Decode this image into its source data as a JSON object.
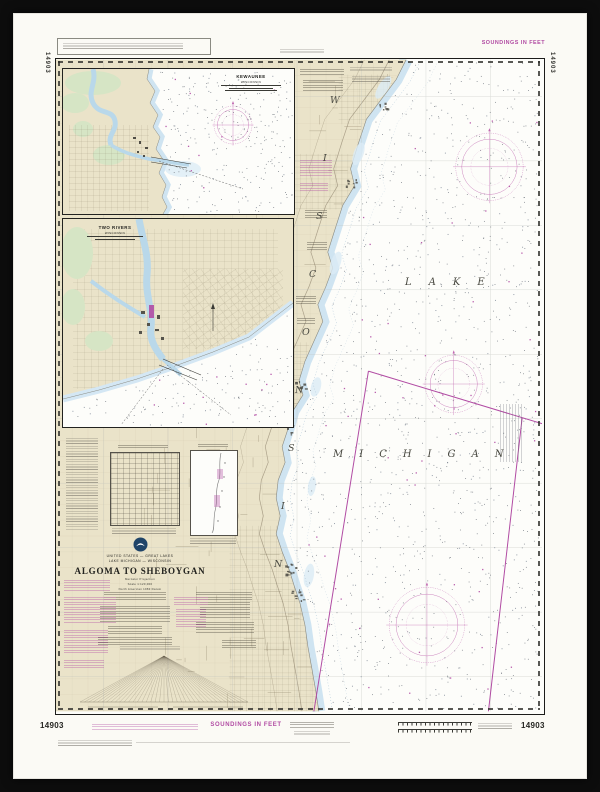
{
  "colors": {
    "frame": "#0d0d0d",
    "paper": "#fbfaf5",
    "land_tan": "#eae3c9",
    "shallow_blue": "#cfe4f1",
    "park_green": "#d6e5c5",
    "magenta_accent": "#b14ba3",
    "ink": "#22221f"
  },
  "margins": {
    "soundings_top": "SOUNDINGS IN FEET",
    "soundings_bottom": "SOUNDINGS IN FEET",
    "chart_number": "14903"
  },
  "title_block": {
    "nation_line": "UNITED STATES — GREAT LAKES",
    "region_line": "LAKE MICHIGAN — WISCONSIN",
    "title": "ALGOMA TO SHEBOYGAN",
    "projection_line": "Mercator Projection",
    "scale_line": "Scale 1:120,000",
    "datum_line": "North American 1983 Datum"
  },
  "insets": [
    {
      "title": "KEWAUNEE",
      "subtitle": "WISCONSIN"
    },
    {
      "title": "TWO RIVERS",
      "subtitle": "WISCONSIN"
    }
  ],
  "map_labels": {
    "lake": "LAKE",
    "lake2": "MICHIGAN",
    "state": "WISCONSIN",
    "state_letters": [
      "W",
      "I",
      "S",
      "C",
      "O",
      "N",
      "S",
      "I",
      "N"
    ]
  }
}
